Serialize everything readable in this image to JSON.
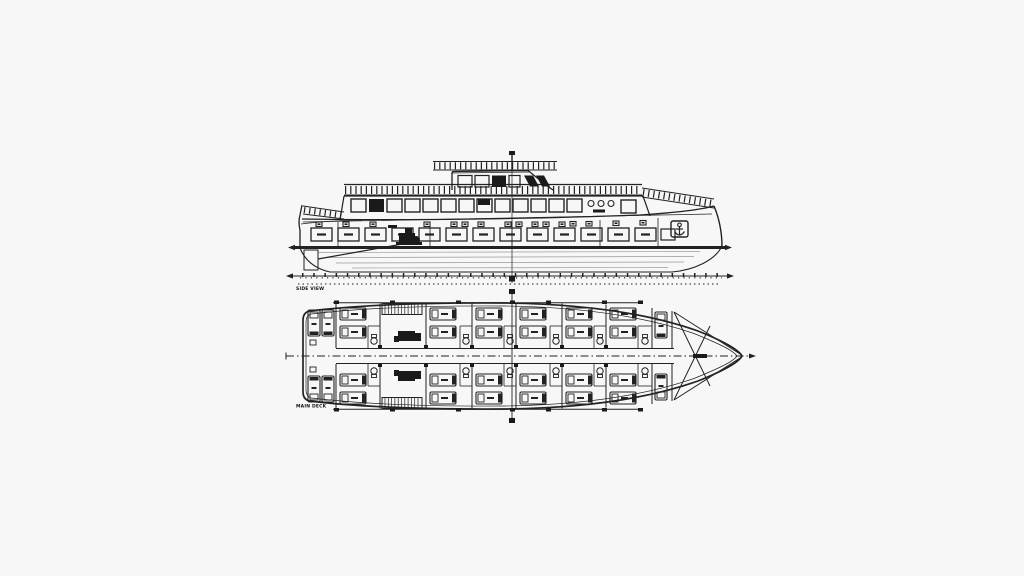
{
  "drawing": {
    "subject": "motor-yacht-general-arrangement",
    "views": {
      "profile": {
        "caption": "SIDE VIEW"
      },
      "deck": {
        "caption": "MAIN DECK"
      }
    },
    "icons": {
      "anchor": "anchor-icon"
    },
    "colors": {
      "background": "#f7f7f7",
      "ink": "#222222",
      "heavy_ink": "#111111",
      "faint": "#999999"
    }
  }
}
